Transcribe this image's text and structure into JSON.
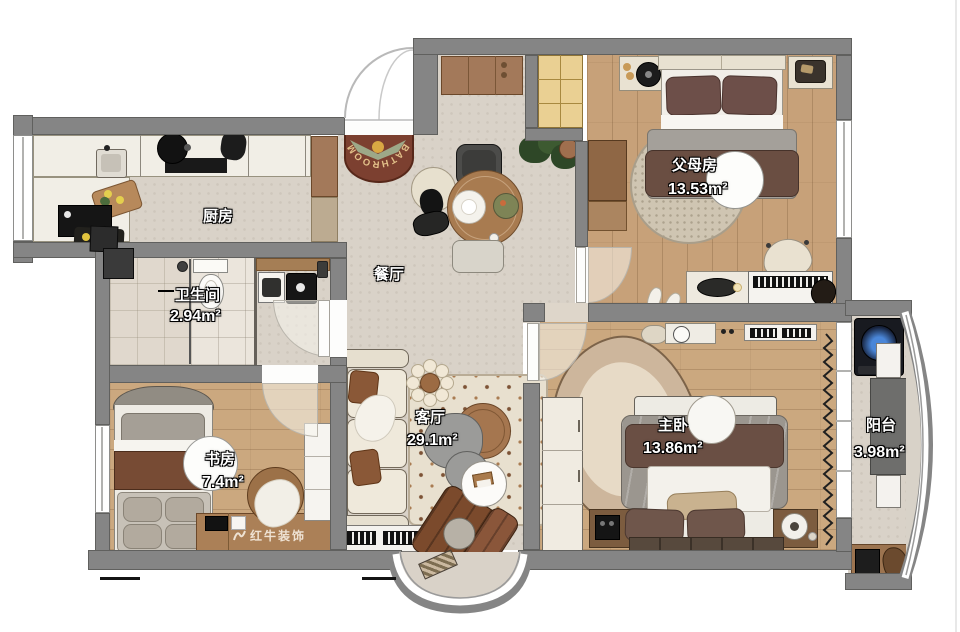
{
  "plan": {
    "rooms": [
      {
        "key": "kitchen",
        "name": "厨房",
        "area": ""
      },
      {
        "key": "dining",
        "name": "餐厅",
        "area": ""
      },
      {
        "key": "bathroom",
        "name": "卫生间",
        "area": "2.94m²"
      },
      {
        "key": "study",
        "name": "书房",
        "area": "7.4m²"
      },
      {
        "key": "living",
        "name": "客厅",
        "area": "29.1m²"
      },
      {
        "key": "master-bedroom",
        "name": "主卧",
        "area": "13.86m²"
      },
      {
        "key": "parents-bedroom",
        "name": "父母房",
        "area": "13.53m²"
      },
      {
        "key": "balcony",
        "name": "阳台",
        "area": "3.98m²"
      }
    ],
    "doormat": {
      "text": "BATHROOM"
    },
    "watermark": {
      "brand": "红牛装饰"
    },
    "colors": {
      "wall": "#858585",
      "tile_floor": "#d9d2c8",
      "wood_floor": "#c7a179",
      "bath_tile": "#ebe5dc",
      "cabinet_brown": "#a3795a",
      "mat_red": "#7c4030",
      "closet_yellow": "#ead093"
    }
  }
}
